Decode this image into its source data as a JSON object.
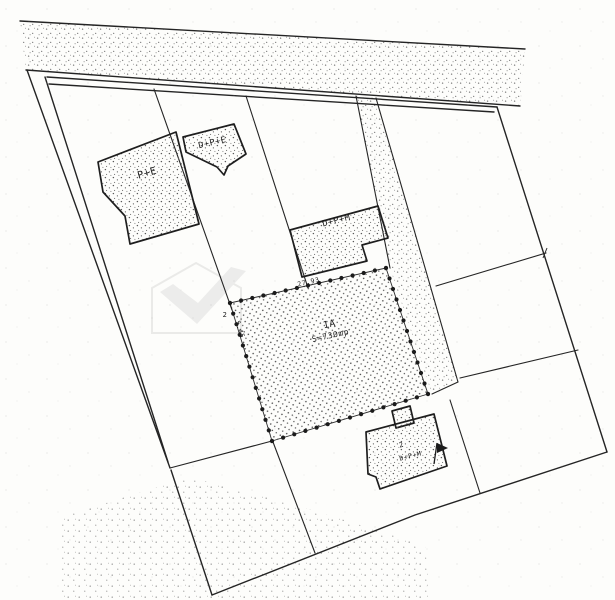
{
  "plan": {
    "parcel": {
      "id": "1A",
      "area": "S=730mp"
    },
    "dimensions": {
      "top_side": "27.93",
      "left_side": "5.45",
      "corner_point": "2"
    },
    "buildings": {
      "b1": {
        "label": "P+E"
      },
      "b2": {
        "label": "D+P+E"
      },
      "b3": {
        "label": "D+P+M"
      },
      "b4": {
        "number": "2",
        "label": "D+P+M"
      }
    },
    "colors": {
      "paper": "#fdfdfb",
      "ink": "#242424",
      "stipple": "#5a5a5a",
      "watermark": "#c2c2c2"
    }
  }
}
